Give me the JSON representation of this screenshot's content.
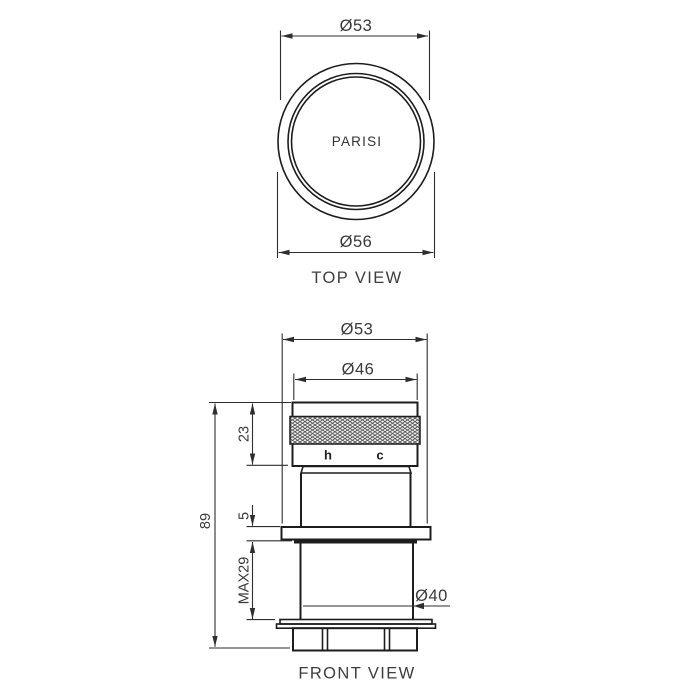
{
  "page": {
    "background": "#ffffff"
  },
  "colors": {
    "object_line": "#1d1d1d",
    "dimension_line": "#2e2e2e",
    "text": "#3a3a3a",
    "knurl_hatch": "#4d4d4d"
  },
  "top_view": {
    "title": "TOP VIEW",
    "dim_outer_top": "Ø53",
    "dim_outer_bottom": "Ø56",
    "brand": "PARISI"
  },
  "front_view": {
    "title": "FRONT VIEW",
    "dim_flange": "Ø53",
    "dim_handle": "Ø46",
    "dim_handle_height": "23",
    "dim_overall_height": "89",
    "dim_flange_thickness": "5",
    "dim_max_wall": "MAX29",
    "dim_body": "Ø40",
    "hot": "h",
    "cold": "c"
  }
}
